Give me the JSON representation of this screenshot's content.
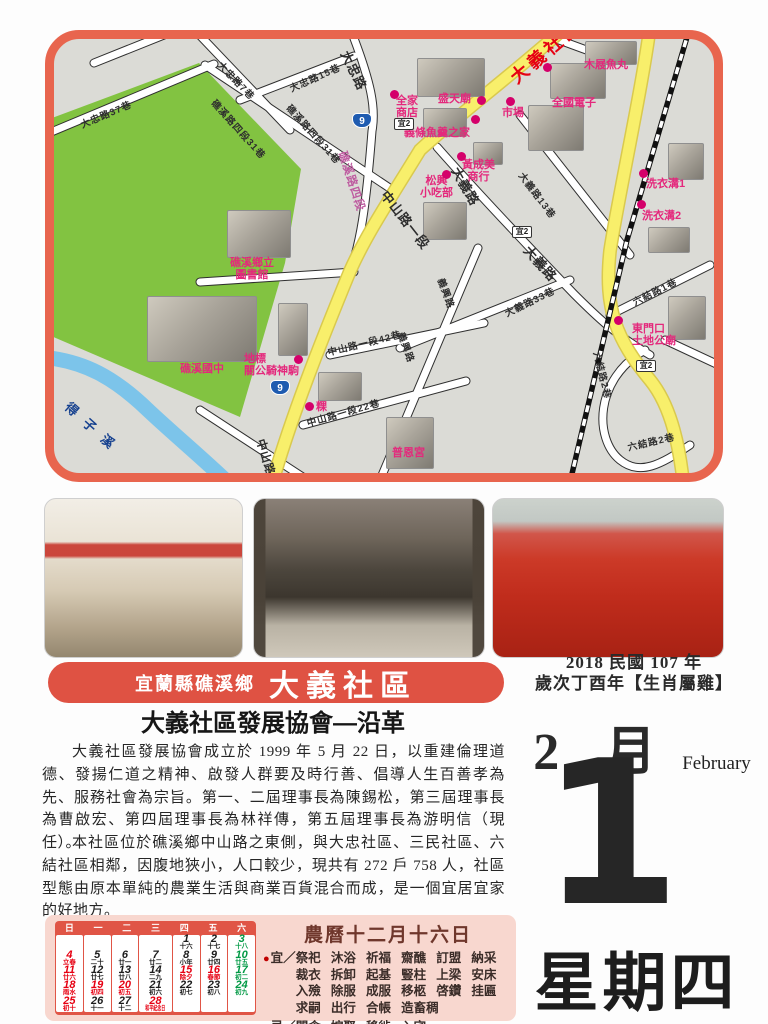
{
  "map": {
    "area_label": "大義社區",
    "badges": {
      "hw9": "9",
      "yi2": "宜2"
    },
    "roads": {
      "dazhong7": "大忠路7巷",
      "dazhong37": "大忠路37巷",
      "dazhong15": "大忠路15巷",
      "dazhong": "大忠路",
      "jiaoxi31a": "礁溪路四段31巷",
      "jiaoxi31b": "礁溪路四段31巷",
      "jiaoxi4": "礁溪路四段",
      "zhongshan_a": "中山路一段",
      "zhongshan_b": "中山路一段",
      "zhongshan42": "中山路一段42巷",
      "zhongshan22": "中山路一段22巷",
      "dayi_a": "大義路",
      "dayi_b": "大義路",
      "dayi13": "大義路13巷",
      "dayi33": "大義路33巷",
      "yixing_a": "義興路",
      "yixing_b": "義興路",
      "liujie1": "六結路1巷",
      "liujie2a": "六結路2巷",
      "liujie2b": "六結路2巷",
      "river": "得子溪"
    },
    "pois": {
      "muji": "木屐魚丸",
      "shengtian": "盛天廟",
      "family": "全家\n商店",
      "fishsoup": "義條魚羹之家",
      "market": "市場",
      "elife": "全國電子",
      "huang": "黃成美\n商行",
      "songxing": "松興\n小吃部",
      "wash1": "洗衣溝1",
      "wash2": "洗衣溝2",
      "eastgate": "東門口\n土地公廟",
      "library": "礁溪鄉立\n圖書館",
      "school": "礁溪國中",
      "landmark": "地標\n關公騎神駒",
      "guo": "粿",
      "puen": "普恩宮"
    }
  },
  "banner": {
    "region": "宜蘭縣礁溪鄉",
    "community": "大義社區"
  },
  "article": {
    "heading": "大義社區發展協會—沿革",
    "p1": "大義社區發展協會成立於 1999 年 5 月 22 日，以重建倫理道德、發揚仁道之精神、啟發人群要及時行善、倡導人生百善孝為先、服務社會為宗旨。第一、二屆理事長為陳錫松，第三屆理事長為曹啟宏、第四屆理事長為林祥傳，第五屆理事長為游明信（現任）。",
    "p2": "本社區位於礁溪鄉中山路之東側，與大忠社區、三民社區、六結社區相鄰，因腹地狹小，人口較少，現共有 272 戶 758 人，社區型態由原本單純的農業生活與商業百貨混合而成，是一個宜居宜家的好地方。"
  },
  "date": {
    "year_line": "2018 民國 107 年",
    "zodiac_line": "歲次丁酉年【生肖屬雞】",
    "month_cn": "2 月",
    "month_en": "February",
    "day": "1",
    "weekday": "星期四"
  },
  "almanac": {
    "title": "農曆十二月十六日",
    "yi_label": "宜",
    "ji_label": "忌",
    "sep": "／",
    "yi": "祭祀 沐浴 祈福 齋醮 訂盟 納采 裁衣 拆卸 起基 豎柱 上梁 安床 入殮 除服 成服 移柩 啓鑽 挂匾 求嗣 出行 合帳 造畜稠",
    "ji": "開倉 嫁娶 移徙 入宅"
  },
  "calendar": {
    "header": [
      "日",
      "一",
      "二",
      "三",
      "四",
      "五",
      "六"
    ],
    "cols": [
      {
        "cells": [
          {},
          {
            "n": "4",
            "s": "立春",
            "c": "r"
          },
          {
            "n": "11",
            "s": "廿六",
            "c": "r"
          },
          {
            "n": "18",
            "s": "雨水",
            "c": "r"
          },
          {
            "n": "25",
            "s": "初十",
            "c": "r"
          }
        ]
      },
      {
        "cells": [
          {},
          {
            "n": "5",
            "s": "二十",
            "c": "k"
          },
          {
            "n": "12",
            "s": "廿七",
            "c": "k"
          },
          {
            "n": "19",
            "s": "初四",
            "c": "r"
          },
          {
            "n": "26",
            "s": "十一",
            "c": "k"
          }
        ]
      },
      {
        "cells": [
          {},
          {
            "n": "6",
            "s": "廿一",
            "c": "k"
          },
          {
            "n": "13",
            "s": "廿八",
            "c": "k"
          },
          {
            "n": "20",
            "s": "初五",
            "c": "r"
          },
          {
            "n": "27",
            "s": "十二",
            "c": "k"
          }
        ]
      },
      {
        "cells": [
          {},
          {
            "n": "7",
            "s": "廿二",
            "c": "k"
          },
          {
            "n": "14",
            "s": "二九",
            "c": "k"
          },
          {
            "n": "21",
            "s": "初六",
            "c": "k"
          },
          {
            "n": "28",
            "s": "和平紀念日",
            "c": "r"
          }
        ]
      },
      {
        "cells": [
          {
            "n": "1",
            "s": "十六",
            "c": "k"
          },
          {
            "n": "8",
            "s": "小年",
            "c": "k"
          },
          {
            "n": "15",
            "s": "除夕",
            "c": "r"
          },
          {
            "n": "22",
            "s": "初七",
            "c": "k"
          },
          {}
        ]
      },
      {
        "cells": [
          {
            "n": "2",
            "s": "十七",
            "c": "k"
          },
          {
            "n": "9",
            "s": "廿四",
            "c": "k"
          },
          {
            "n": "16",
            "s": "春節",
            "c": "r"
          },
          {
            "n": "23",
            "s": "初八",
            "c": "k"
          },
          {}
        ]
      },
      {
        "cells": [
          {
            "n": "3",
            "s": "十八",
            "c": "g"
          },
          {
            "n": "10",
            "s": "廿五",
            "c": "g"
          },
          {
            "n": "17",
            "s": "初二",
            "c": "g"
          },
          {
            "n": "24",
            "s": "初九",
            "c": "g"
          },
          {}
        ]
      }
    ]
  }
}
